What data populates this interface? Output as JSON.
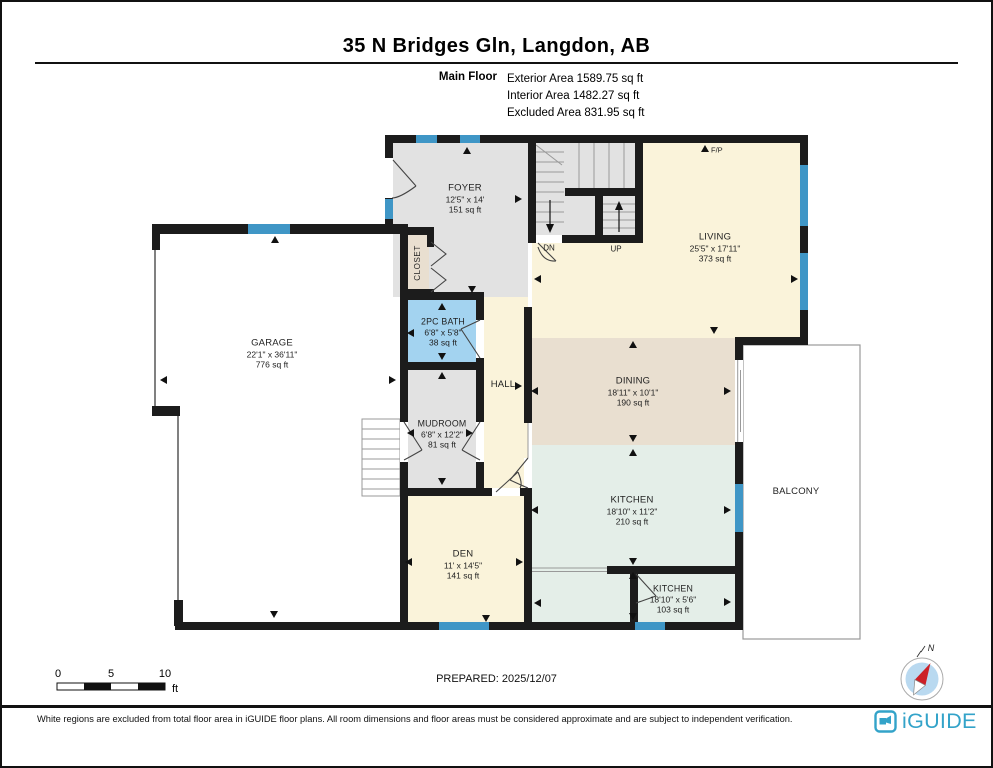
{
  "header": {
    "title": "35 N Bridges Gln, Langdon, AB",
    "floor_label": "Main Floor",
    "exterior_area": "Exterior Area 1589.75 sq ft",
    "interior_area": "Interior Area 1482.27 sq ft",
    "excluded_area": "Excluded Area 831.95 sq ft"
  },
  "rooms": {
    "foyer": {
      "name": "FOYER",
      "dims": "12'5\" x 14'",
      "area": "151 sq ft"
    },
    "living": {
      "name": "LIVING",
      "dims": "25'5\" x 17'11\"",
      "area": "373 sq ft"
    },
    "garage": {
      "name": "GARAGE",
      "dims": "22'1\" x 36'11\"",
      "area": "776 sq ft"
    },
    "closet": {
      "name": "CLOSET"
    },
    "bath": {
      "name": "2PC BATH",
      "dims": "6'8\" x 5'8\"",
      "area": "38 sq ft"
    },
    "hall": {
      "name": "HALL"
    },
    "mudroom": {
      "name": "MUDROOM",
      "dims": "6'8\" x 12'2\"",
      "area": "81 sq ft"
    },
    "dining": {
      "name": "DINING",
      "dims": "18'11\" x 10'1\"",
      "area": "190 sq ft"
    },
    "kitchen": {
      "name": "KITCHEN",
      "dims": "18'10\" x 11'2\"",
      "area": "210 sq ft"
    },
    "kitchen2": {
      "name": "KITCHEN",
      "dims": "18'10\" x 5'6\"",
      "area": "103 sq ft"
    },
    "den": {
      "name": "DEN",
      "dims": "11' x 14'5\"",
      "area": "141 sq ft"
    },
    "balcony": {
      "name": "BALCONY"
    }
  },
  "plan_markers": {
    "down": "DN",
    "up": "UP",
    "fireplace": "F/P"
  },
  "scale_bar": {
    "tick_0": "0",
    "tick_5": "5",
    "tick_10": "10",
    "unit": "ft"
  },
  "compass": {
    "north": "N"
  },
  "footer": {
    "prepared": "PREPARED: 2025/12/07",
    "disclaimer": "White regions are excluded from total floor area in iGUIDE floor plans. All room dimensions and floor areas must be considered approximate and are subject to independent verification.",
    "brand": "iGUIDE"
  },
  "colors": {
    "wall": "#1c1c1c",
    "window": "#3f96c6",
    "floor_cream": "#faf3da",
    "floor_gray": "#e2e2e2",
    "floor_tan": "#e9dfd0",
    "floor_blue": "#a3d3f0",
    "floor_mint": "#e4eee8",
    "balcony_outline": "#999999",
    "brand_teal": "#33a3c9",
    "needle_red": "#cc2027",
    "compass_blue": "#b9d9f0"
  }
}
